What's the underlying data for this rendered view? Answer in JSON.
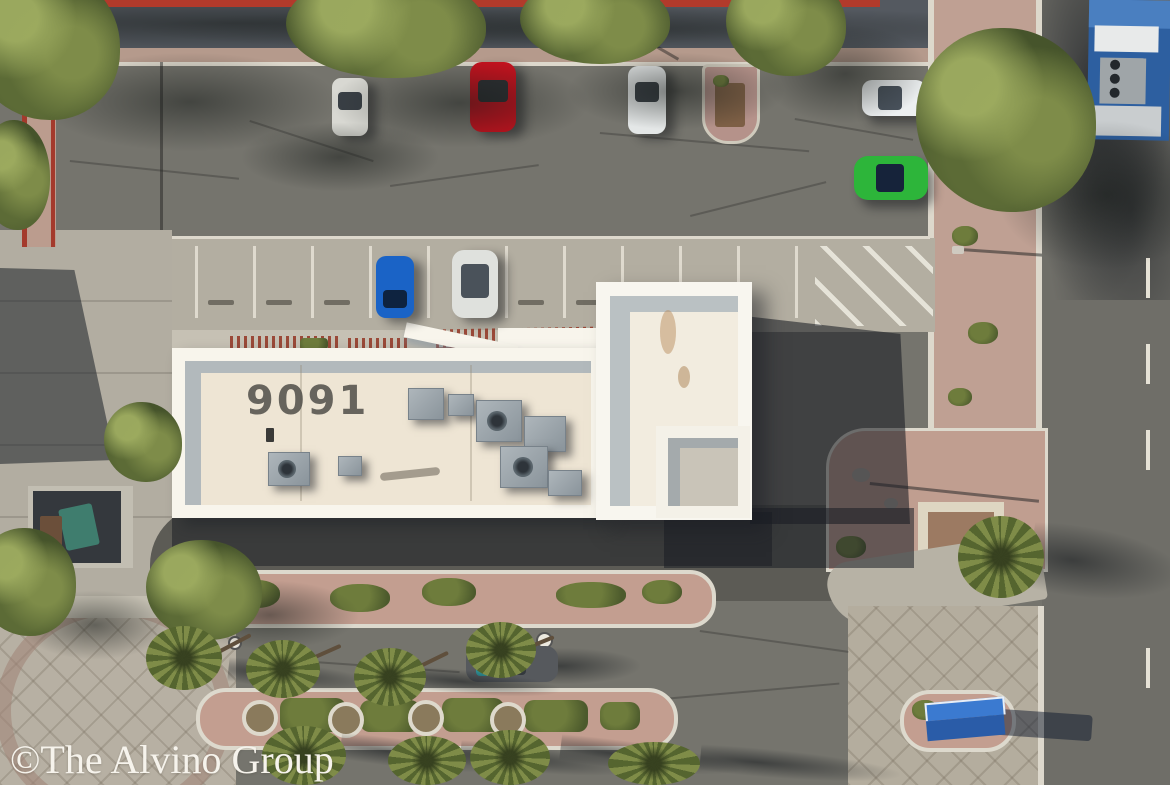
{
  "meta": {
    "type": "aerial-drone-photograph",
    "subject": "Top-down aerial view of a single-story commercial building with rooftop HVAC units, parking lot, palm-lined landscape medians and adjacent streets"
  },
  "text": {
    "roof_number": "9091",
    "watermark": "©The Alvino Group"
  },
  "palette": {
    "asphalt": "#75746d",
    "asphalt_street": "#6f6e68",
    "street_shade": "#50555b",
    "deep_shadow": "#2b2f36",
    "concrete": "#b3aea1",
    "concrete_light": "#c6c1b4",
    "white_curb": "#ddd8cc",
    "gravel_pink": "#c29d90",
    "roof_parapet": "#f8f5ec",
    "roof_field": "#eee5d4",
    "parapet_shadow": "#8fa2b4",
    "foliage": "#7a8741",
    "foliage_dark": "#4c5a2c",
    "curb_red": "#b23a2b",
    "railing_rust": "#9a4938"
  },
  "vehicles": [
    {
      "id": "silver-car-top-row",
      "color": "#d8d8d2"
    },
    {
      "id": "red-car-top-row",
      "color": "#c5121e"
    },
    {
      "id": "white-sedan-top-row",
      "color": "#e4e7e7"
    },
    {
      "id": "white-car-east-lane",
      "color": "#edf0f1"
    },
    {
      "id": "green-car-east-lane",
      "color": "#2db53a"
    },
    {
      "id": "blue-car-center-row",
      "color": "#1a63c6"
    },
    {
      "id": "white-suv-center-row",
      "color": "#dfe1dd"
    },
    {
      "id": "gray-car-moving",
      "color": "#56595d"
    },
    {
      "id": "blue-truck-street",
      "color": "#2d5fa0"
    }
  ],
  "signage": {
    "median_monument_sign_color": "#3b7ad0"
  }
}
